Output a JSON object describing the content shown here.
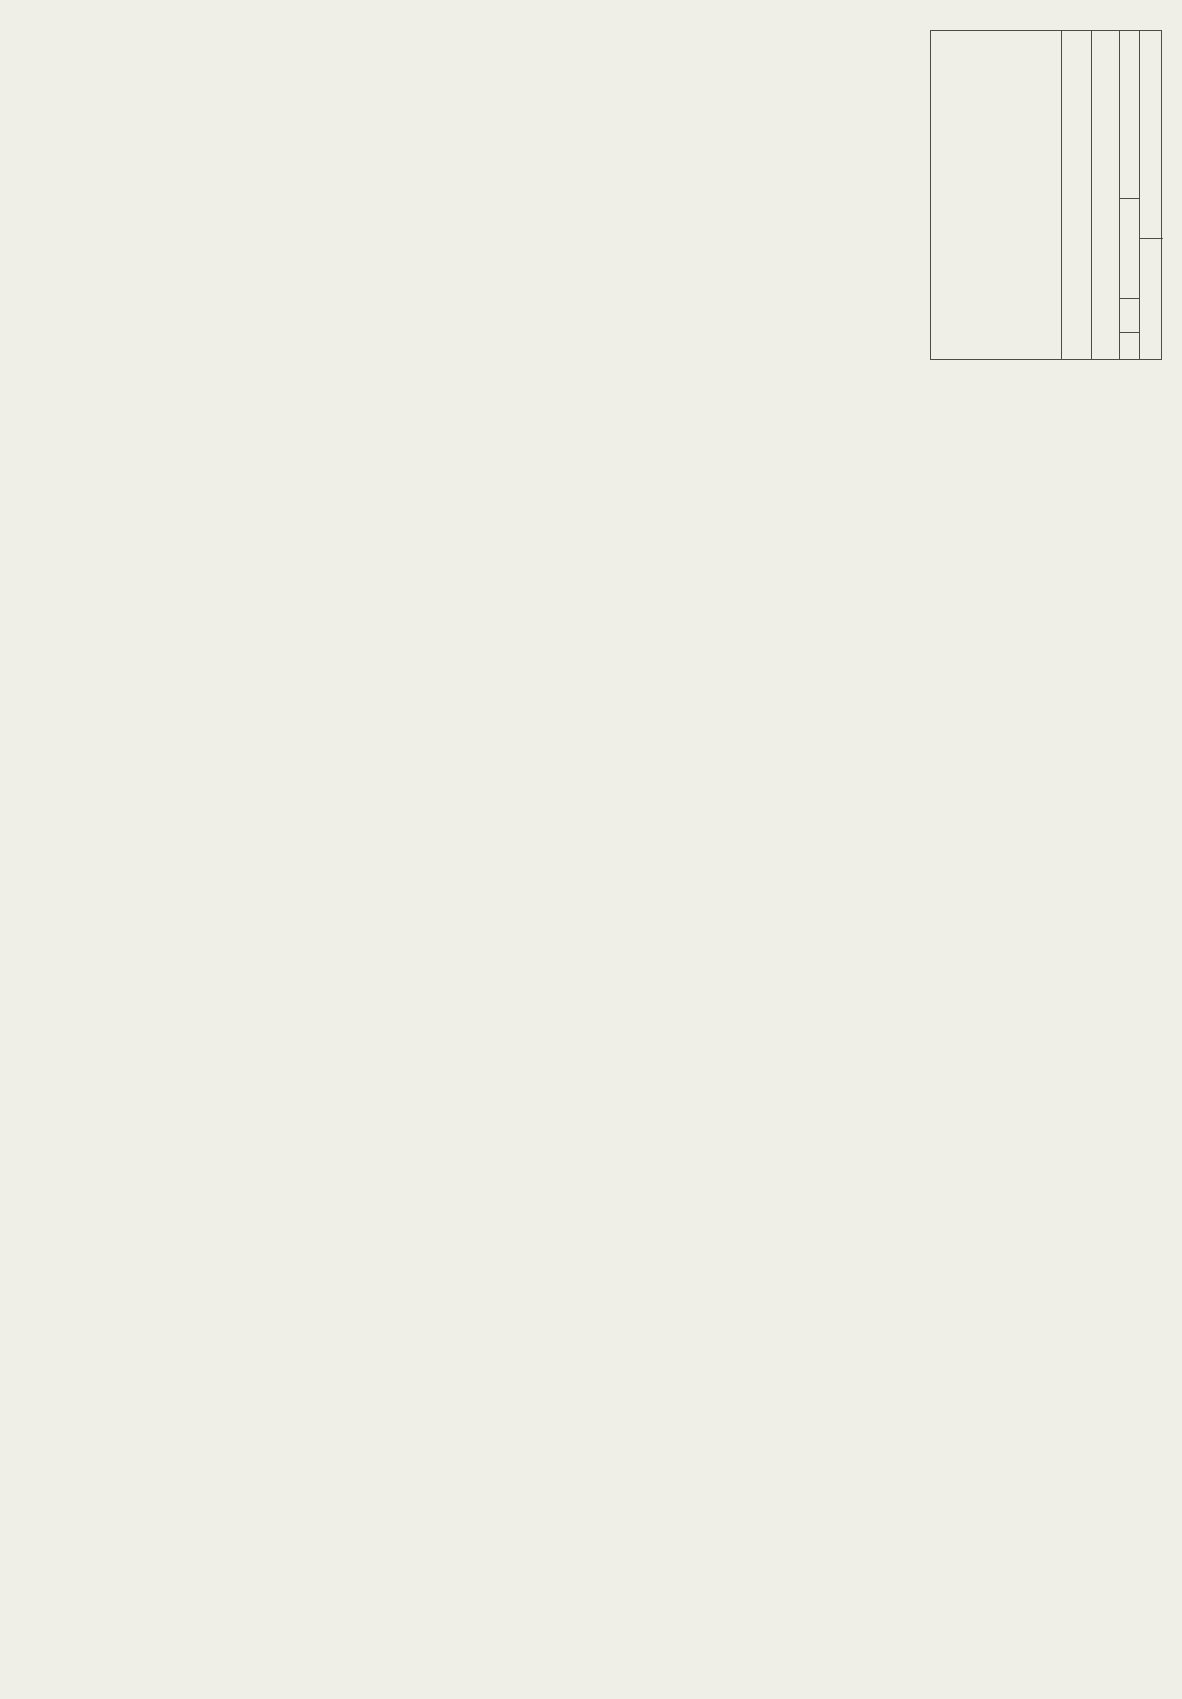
{
  "page": {
    "bg": "#efeee7",
    "ink": "#504e47",
    "text": "#3f3e39"
  },
  "title_block": {
    "company": "TELEMANN CO., LTD",
    "company2": "Satellite Solutions",
    "title_label": "Title",
    "title": "AURORA (DTR6000N)",
    "desc_label": "Description",
    "description": "MPEG2 DECODER",
    "rev_label": "Rev",
    "rev": "0.2",
    "size_label": "Size",
    "sheet_label": "Sheet",
    "sheet_no": "6",
    "sheet_sep": "/",
    "sheet_total": "18",
    "design_label": "Design",
    "verif_label": "Verification",
    "verif": "Telemann"
  },
  "zones": {
    "cols": [
      "1",
      "2",
      "3",
      "4"
    ],
    "rows": [
      "E",
      "D",
      "C",
      "B",
      "A"
    ]
  },
  "power": {
    "v33": "3V3"
  },
  "chip": {
    "ref": "U13",
    "part": "STI3520L",
    "left": [
      [
        1,
        "LRCLK"
      ],
      [
        2,
        "SCLK"
      ],
      [
        3,
        "DQ30"
      ],
      [
        4,
        "DQ29"
      ],
      [
        5,
        "DQ28"
      ],
      [
        6,
        "DQ27"
      ],
      [
        7,
        "DQ26"
      ],
      [
        8,
        "DQ25"
      ],
      [
        9,
        "DQ24"
      ],
      [
        10,
        "DQ23"
      ],
      [
        11,
        "VDD"
      ],
      [
        12,
        "GND"
      ],
      [
        13,
        "DQ22"
      ],
      [
        14,
        "DQ21"
      ],
      [
        15,
        "DQ20"
      ],
      [
        16,
        "DQ19"
      ],
      [
        17,
        "DQ18"
      ],
      [
        18,
        "DQ17"
      ],
      [
        19,
        "DQ16"
      ],
      [
        20,
        "VDD"
      ],
      [
        21,
        "DQ15"
      ],
      [
        22,
        "DQ14"
      ],
      [
        23,
        "DQ13"
      ],
      [
        24,
        "DQ12"
      ],
      [
        25,
        "DQ11"
      ],
      [
        26,
        "DQ10"
      ],
      [
        27,
        "VDD"
      ],
      [
        28,
        "GND"
      ],
      [
        29,
        "DQ9"
      ],
      [
        30,
        "DQ8"
      ],
      [
        31,
        "DQ7"
      ],
      [
        32,
        "DQ6"
      ],
      [
        33,
        "DQ5"
      ],
      [
        34,
        "DQ4"
      ],
      [
        35,
        "DQ3"
      ],
      [
        36,
        "DQ2"
      ],
      [
        37,
        "DQ1"
      ],
      [
        38,
        "DQ0"
      ],
      [
        39,
        "GND"
      ],
      [
        40,
        "VDD"
      ]
    ],
    "bottom": [
      [
        41,
        "PCMDATA"
      ],
      [
        42,
        "PCMCLK"
      ],
      [
        43,
        "NC"
      ],
      [
        44,
        "NC"
      ],
      [
        45,
        "NC"
      ],
      [
        46,
        "VDD"
      ],
      [
        47,
        "GND"
      ],
      [
        48,
        "NC"
      ],
      [
        49,
        "NC"
      ],
      [
        50,
        "NC"
      ],
      [
        51,
        "GND"
      ],
      [
        52,
        "AA11"
      ],
      [
        53,
        "AA10"
      ],
      [
        54,
        "AA9"
      ],
      [
        55,
        "CS",
        "b"
      ],
      [
        56,
        "WE",
        "b"
      ],
      [
        57,
        "CAS",
        "b"
      ],
      [
        58,
        "RAS",
        "b"
      ],
      [
        59,
        "CKE"
      ],
      [
        60,
        "DQM"
      ],
      [
        61,
        "NC"
      ],
      [
        62,
        "VDD"
      ],
      [
        63,
        "GND"
      ],
      [
        64,
        "NC"
      ],
      [
        65,
        "NC"
      ],
      [
        66,
        "NC"
      ],
      [
        67,
        "NC"
      ],
      [
        68,
        "VDD_PLL"
      ],
      [
        69,
        "NC"
      ],
      [
        70,
        "GND_PLL"
      ],
      [
        71,
        "AA8"
      ],
      [
        72,
        "VDD"
      ],
      [
        73,
        "AA7"
      ],
      [
        74,
        "AA6"
      ],
      [
        75,
        "AA5"
      ],
      [
        76,
        "AA4"
      ],
      [
        77,
        "AA3"
      ],
      [
        78,
        "AA2"
      ],
      [
        79,
        "AUDREQ",
        "b"
      ],
      [
        80,
        "AUDSTR",
        "b"
      ]
    ],
    "right": [
      [
        81,
        "AUDPTS"
      ],
      [
        82,
        "AUDCLK"
      ],
      [
        83,
        "AA1"
      ],
      [
        84,
        "AA0"
      ],
      [
        85,
        "GND"
      ],
      [
        86,
        "VDD"
      ],
      [
        87,
        "PIXCLK"
      ],
      [
        88,
        "YC0"
      ],
      [
        89,
        "YC1"
      ],
      [
        90,
        "YC2"
      ],
      [
        91,
        "YC3"
      ],
      [
        92,
        "YC4"
      ],
      [
        93,
        "YC5"
      ],
      [
        94,
        "YC6"
      ],
      [
        95,
        "YC7"
      ],
      [
        96,
        "HSYNC",
        "b"
      ],
      [
        97,
        "B/T",
        "b"
      ],
      [
        98,
        "GND"
      ],
      [
        99,
        "GND"
      ],
      [
        100,
        "VIDCLK"
      ],
      [
        101,
        "GND"
      ],
      [
        102,
        "RESET",
        "bo"
      ],
      [
        103,
        "D0"
      ],
      [
        104,
        "D1"
      ],
      [
        105,
        "D2"
      ],
      [
        106,
        "D3"
      ],
      [
        107,
        "D4"
      ],
      [
        108,
        "D5"
      ],
      [
        109,
        "D6"
      ],
      [
        110,
        "D7"
      ],
      [
        111,
        "VIDREQ",
        "o"
      ],
      [
        112,
        "VDD"
      ],
      [
        113,
        "GND"
      ],
      [
        114,
        "NC"
      ],
      [
        115,
        "NC"
      ],
      [
        116,
        "NC"
      ],
      [
        117,
        "SDRAMCLK"
      ],
      [
        118,
        "VDD"
      ],
      [
        119,
        "AUDIRQ",
        "o"
      ],
      [
        120,
        "A6"
      ]
    ],
    "top": [
      [
        121,
        "AUDCS",
        "bo"
      ],
      [
        122,
        "GND"
      ],
      [
        123,
        "A7"
      ],
      [
        124,
        "NC"
      ],
      [
        125,
        "A0"
      ],
      [
        126,
        "A1"
      ],
      [
        127,
        "A2"
      ],
      [
        128,
        "A3"
      ],
      [
        129,
        "VDD"
      ],
      [
        130,
        "A4"
      ],
      [
        131,
        "A5"
      ],
      [
        132,
        "VIDCS",
        "b"
      ],
      [
        133,
        "R/W",
        "b"
      ],
      [
        134,
        "WAIT",
        "bo"
      ],
      [
        135,
        "VIDSTR",
        "bo"
      ],
      [
        136,
        "GND"
      ],
      [
        137,
        "VIDRQ",
        "bo"
      ],
      [
        138,
        "NC"
      ],
      [
        139,
        "NC"
      ],
      [
        140,
        "NC"
      ],
      [
        141,
        "NC"
      ],
      [
        142,
        "NC"
      ],
      [
        143,
        "VDD"
      ],
      [
        144,
        "GND"
      ],
      [
        145,
        "NC"
      ],
      [
        146,
        "NC"
      ],
      [
        147,
        "NC"
      ],
      [
        148,
        "NC"
      ],
      [
        149,
        "NC"
      ],
      [
        150,
        "NC"
      ],
      [
        151,
        "NC"
      ],
      [
        152,
        "VDD"
      ],
      [
        153,
        "GND"
      ],
      [
        154,
        "NC"
      ],
      [
        155,
        "NC"
      ],
      [
        156,
        "NC"
      ],
      [
        157,
        "NC"
      ],
      [
        158,
        "DD31"
      ],
      [
        159,
        "OSD"
      ],
      [
        160,
        "VDD"
      ]
    ]
  },
  "connectors": {
    "group_top_right": [
      "FMA[20..0]",
      "MPWR*",
      "V_IRQ*",
      "V_STR*",
      "V_CS*",
      "A_CS*"
    ],
    "group_irq": [
      "A_IRQ*",
      "V_REQ*"
    ],
    "fmd_bus": "FMD[31..0]",
    "mid": [
      "RST_MPG*",
      "B/T",
      "HSYNC"
    ],
    "ycrcb_bus": "YCRCB[7..0]",
    "clk": "27MHz_VCLK",
    "astr": [
      "A_STR*",
      "A_REQ*"
    ],
    "md_bus": "MD[31..0]",
    "ma_bus": "MA[11..0]",
    "pwr_conn": "3V3",
    "sdr": [
      "SDRCLK",
      "SDRCS*",
      "SDRWE*",
      "SDRCAS*",
      "SDRRAS*",
      "SDRCKE",
      "SDRDQM"
    ],
    "audio": [
      "AUDCLK",
      "PCM_DATA",
      "PCM_CLK",
      "PCM_LRCLK"
    ]
  },
  "net_labels": {
    "right_rows": [
      "FMA6",
      "A_IRQ*",
      "SDRAMCLK",
      "V_REQ*",
      "27MHz_VCLK",
      "B/T",
      "HSYNC",
      "27MHz_VCLK",
      "MA0",
      "MA1",
      "27MHz_VCLK"
    ],
    "fmd": [
      "FMD7",
      "FMD6",
      "FMD5",
      "FMD4",
      "FMD3",
      "FMD2",
      "FMD1",
      "FMD0"
    ],
    "ycrcb": [
      "YCRCB7",
      "YCRCB6",
      "YCRCB5",
      "YCRCB4",
      "YCRCB3",
      "YCRCB2",
      "YCRCB1",
      "YCRCB0"
    ],
    "fma": [
      "FMA7",
      "FMA0",
      "FMA1",
      "FMA2",
      "FMA3",
      "FMA4",
      "FMA5"
    ],
    "md31": "MD31",
    "md": [
      "MD30",
      "MD29",
      "MD28",
      "MD27",
      "MD26",
      "MD25",
      "MD24",
      "MD23",
      "MD22",
      "MD21",
      "MD20",
      "MD19",
      "MD18",
      "MD17",
      "MD16",
      "MD15",
      "MD14",
      "MD13",
      "MD12",
      "MD11",
      "MD10",
      "MD9",
      "MD8",
      "MD7",
      "MD6",
      "MD5",
      "MD4",
      "MD3",
      "MD2",
      "MD1",
      "MD0"
    ],
    "ma": [
      "MA11",
      "MA10",
      "MA9",
      "MA8",
      "MA7",
      "MA6",
      "MA5",
      "MA4",
      "MA3",
      "MA2"
    ],
    "sdramclk": "SDRAMCLK"
  },
  "components": {
    "c22": [
      [
        "C50",
        "22PF"
      ],
      [
        "C66",
        "22PF"
      ],
      [
        "C51",
        "22PF"
      ],
      [
        "C62",
        "22PF"
      ],
      [
        "C64",
        "22PF"
      ]
    ],
    "c69": [
      "C69",
      "22PF"
    ],
    "c01": [
      [
        "C30",
        "0.1UF"
      ],
      [
        "C42",
        "0.1UF"
      ],
      [
        "C43",
        "0.1UF"
      ],
      [
        "C52",
        "0.1UF"
      ],
      [
        "C67",
        "0.1UF"
      ]
    ],
    "c73": [
      "C73",
      "0.1UF"
    ],
    "c74": [
      "C74",
      "0.1UF"
    ],
    "r95": [
      "R95",
      "100K"
    ],
    "r66": [
      "R66",
      "200"
    ],
    "r65": [
      "R65",
      "47"
    ],
    "rn9": [
      "RN9",
      "47A"
    ],
    "rn10": [
      "RN10",
      "47A"
    ],
    "rn4": [
      "RN4",
      "47A"
    ],
    "rn5": [
      "RN5",
      "10KA"
    ],
    "rn6": [
      "RN6",
      "10KA"
    ]
  }
}
